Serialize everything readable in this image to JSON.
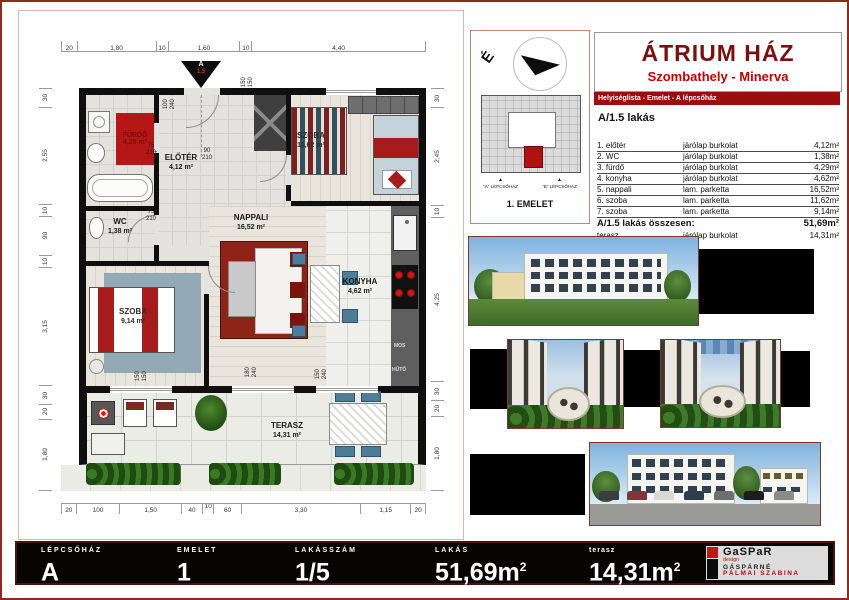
{
  "header": {
    "title": "ÁTRIUM HÁZ",
    "subtitle": "Szombathely - Minerva",
    "banner": "Helyiséglista - Emelet - A lépcsőház"
  },
  "site": {
    "north": "É",
    "marker": "▲",
    "stair_a": "\"A\" LÉPCSŐHÁZ",
    "stair_b": "\"B\" LÉPCSŐHÁZ",
    "floor": "1. EMELET"
  },
  "apartment": {
    "label": "A/1.5 lakás",
    "total_label": "A/1.5  lakás összesen:",
    "total_area": "51,69m²"
  },
  "room_table": {
    "rows": [
      {
        "name": "1. előtér",
        "finish": "járólap burkolat",
        "area": "4,12m²"
      },
      {
        "name": "2. WC",
        "finish": "járólap burkolat",
        "area": "1,38m²"
      },
      {
        "name": "3. fürdő",
        "finish": "járólap burkolat",
        "area": "4,29m²"
      },
      {
        "name": "4. konyha",
        "finish": "járólap burkolat",
        "area": "4,62m²"
      },
      {
        "name": "5. nappali",
        "finish": "lam. parketta",
        "area": "16,52m²"
      },
      {
        "name": "6. szoba",
        "finish": "lam. parketta",
        "area": "11,62m²"
      },
      {
        "name": "7. szoba",
        "finish": "lam. parketta",
        "area": "9,14m²"
      }
    ],
    "terrace": {
      "name": "terasz",
      "finish": "járólap burkolat",
      "area": "14,31m²"
    }
  },
  "plan": {
    "entry": {
      "line1": "A",
      "line2": "1.5"
    },
    "rooms": {
      "furdo": {
        "name": "FÜRDŐ",
        "area": "4,29 m²"
      },
      "wc": {
        "name": "WC",
        "area": "1,38 m²"
      },
      "eloter": {
        "name": "ELŐTÉR",
        "area": "4,12 m²"
      },
      "nappali": {
        "name": "NAPPALI",
        "area": "16,52 m²"
      },
      "szoba_felso": {
        "name": "SZOBA",
        "area": "11,62 m²"
      },
      "szoba_bal": {
        "name": "SZOBA",
        "area": "9,14 m²"
      },
      "konyha": {
        "name": "KONYHA",
        "area": "4,62 m²"
      },
      "terasz": {
        "name": "TERASZ",
        "area": "14,31 m²"
      }
    },
    "doors": [
      {
        "w": "75",
        "h": "210"
      },
      {
        "w": "75",
        "h": "210"
      },
      {
        "w": "90",
        "h": "210"
      }
    ],
    "windows": [
      {
        "w": "100",
        "h": "240"
      },
      {
        "w": "150",
        "h": "150"
      },
      {
        "w": "150",
        "h": "150"
      },
      {
        "w": "180",
        "h": "240"
      },
      {
        "w": "150",
        "h": "240"
      }
    ],
    "appliances": [
      "MOS",
      "HŰTŐ"
    ],
    "dims": {
      "top": [
        "20",
        "1,80",
        "10",
        "1,60",
        "10",
        "4,40"
      ],
      "left": [
        "30",
        "2,55",
        "10",
        "90",
        "10",
        "3,15",
        "30",
        "20",
        "1,80"
      ],
      "right": [
        "30",
        "2,45",
        "10",
        "4,25",
        "30",
        "20",
        "1,80"
      ],
      "bottom": [
        "20",
        "100",
        "1,50",
        "40",
        "10",
        "60",
        "3,30",
        "1,15",
        "20"
      ]
    }
  },
  "footer": {
    "items": [
      {
        "label": "LÉPCSŐHÁZ",
        "value": "A",
        "sup": ""
      },
      {
        "label": "EMELET",
        "value": "1",
        "sup": ""
      },
      {
        "label": "LAKÁSSZÁM",
        "value": "1/5",
        "sup": ""
      },
      {
        "label": "LAKÁS",
        "value": "51,69m",
        "sup": "2"
      },
      {
        "label": "terasz",
        "value": "14,31m",
        "sup": "2"
      }
    ],
    "logo": {
      "brand": "GaSPaR",
      "tagline": "design",
      "line1": "GÁSPÁRNÉ",
      "line2": "PÁLMAI SZABINA"
    }
  }
}
